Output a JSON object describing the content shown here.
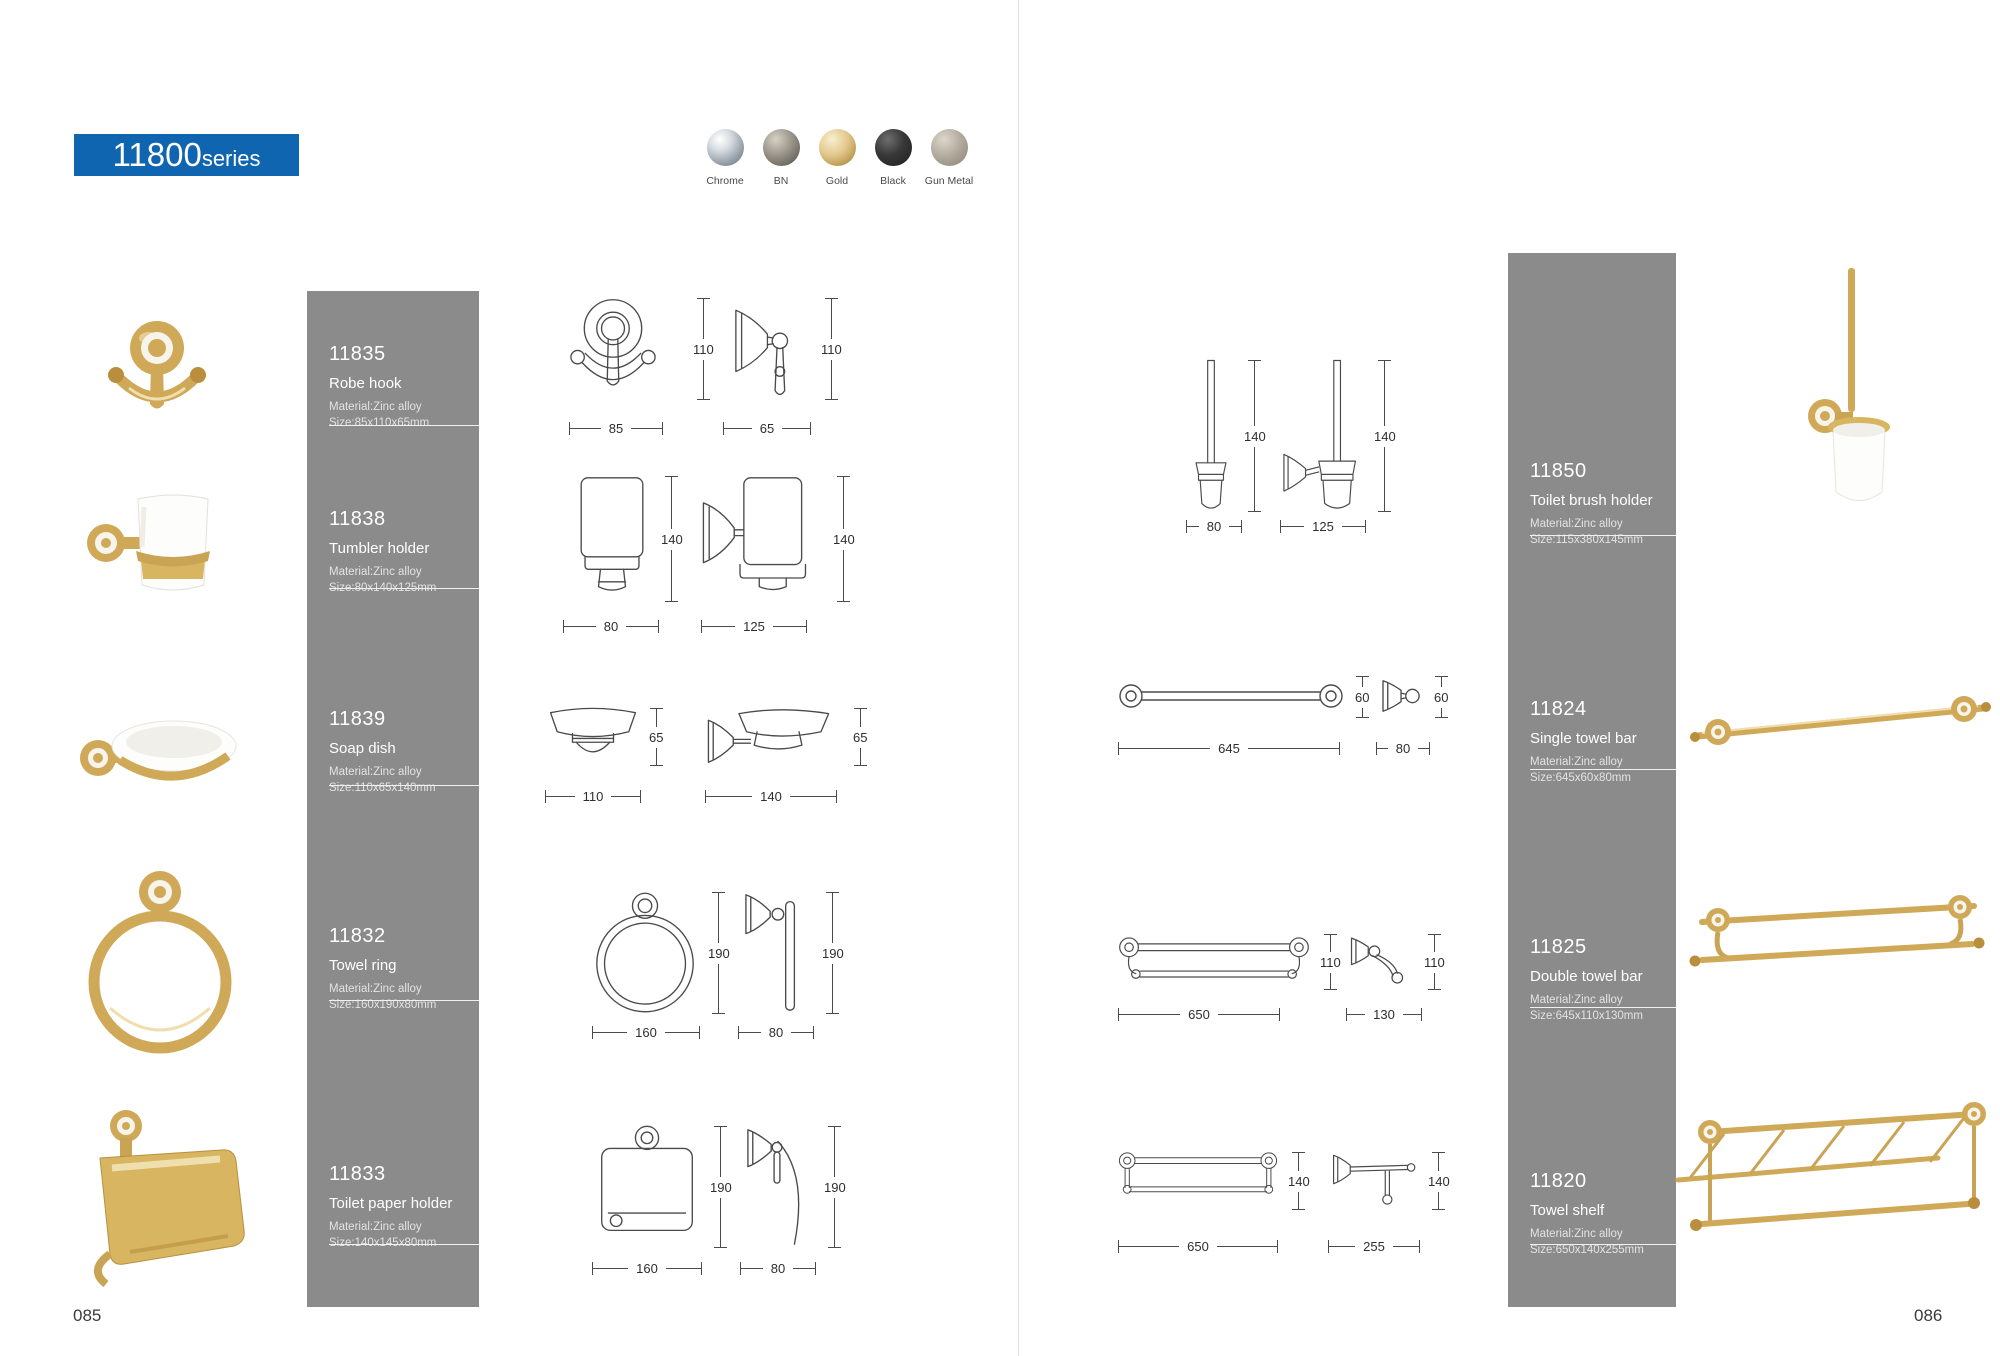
{
  "banner": {
    "number": "11800",
    "suffix": "series"
  },
  "finishes": [
    {
      "label": "Chrome",
      "color": "#c7cdd4"
    },
    {
      "label": "BN",
      "color": "#8f897e"
    },
    {
      "label": "Gold",
      "color": "#dcc185"
    },
    {
      "label": "Black",
      "color": "#222222"
    },
    {
      "label": "Gun Metal",
      "color": "#a59d8f"
    }
  ],
  "page_numbers": {
    "left": "085",
    "right": "086"
  },
  "products_left": [
    {
      "code": "11835",
      "name": "Robe hook",
      "material": "Material:Zinc alloy",
      "size": "Size:85x110x65mm",
      "dims": {
        "front_h": "110",
        "side_h": "110",
        "front_w": "85",
        "side_w": "65"
      }
    },
    {
      "code": "11838",
      "name": "Tumbler holder",
      "material": "Material:Zinc alloy",
      "size": "Size:80x140x125mm",
      "dims": {
        "front_h": "140",
        "side_h": "140",
        "front_w": "80",
        "side_w": "125"
      }
    },
    {
      "code": "11839",
      "name": "Soap dish",
      "material": "Material:Zinc alloy",
      "size": "Size:110x65x140mm",
      "dims": {
        "front_h": "65",
        "side_h": "65",
        "front_w": "110",
        "side_w": "140"
      }
    },
    {
      "code": "11832",
      "name": "Towel ring",
      "material": "Material:Zinc alloy",
      "size": "Size:160x190x80mm",
      "dims": {
        "front_h": "190",
        "side_h": "190",
        "front_w": "160",
        "side_w": "80"
      }
    },
    {
      "code": "11833",
      "name": "Toilet paper holder",
      "material": "Material:Zinc alloy",
      "size": "Size:140x145x80mm",
      "dims": {
        "front_h": "190",
        "side_h": "190",
        "front_w": "160",
        "side_w": "80"
      }
    }
  ],
  "products_right": [
    {
      "code": "11850",
      "name": "Toilet brush holder",
      "material": "Material:Zinc alloy",
      "size": "Size:115x380x145mm",
      "dims": {
        "front_h": "140",
        "side_h": "140",
        "front_w": "80",
        "side_w": "125"
      }
    },
    {
      "code": "11824",
      "name": "Single towel bar",
      "material": "Material:Zinc alloy",
      "size": "Size:645x60x80mm",
      "dims": {
        "front_h": "60",
        "side_h": "60",
        "front_w": "645",
        "side_w": "80"
      }
    },
    {
      "code": "11825",
      "name": "Double towel bar",
      "material": "Material:Zinc alloy",
      "size": "Size:645x110x130mm",
      "dims": {
        "front_h": "110",
        "side_h": "110",
        "front_w": "650",
        "side_w": "130"
      }
    },
    {
      "code": "11820",
      "name": "Towel shelf",
      "material": "Material:Zinc alloy",
      "size": "Size:650x140x255mm",
      "dims": {
        "front_h": "140",
        "side_h": "140",
        "front_w": "650",
        "side_w": "255"
      }
    }
  ],
  "colors": {
    "accent_blue": "#1065b0",
    "panel_gray": "#8b8b8b",
    "gold_finish": "#cfa958",
    "drawing_line": "#4a4a4a"
  }
}
